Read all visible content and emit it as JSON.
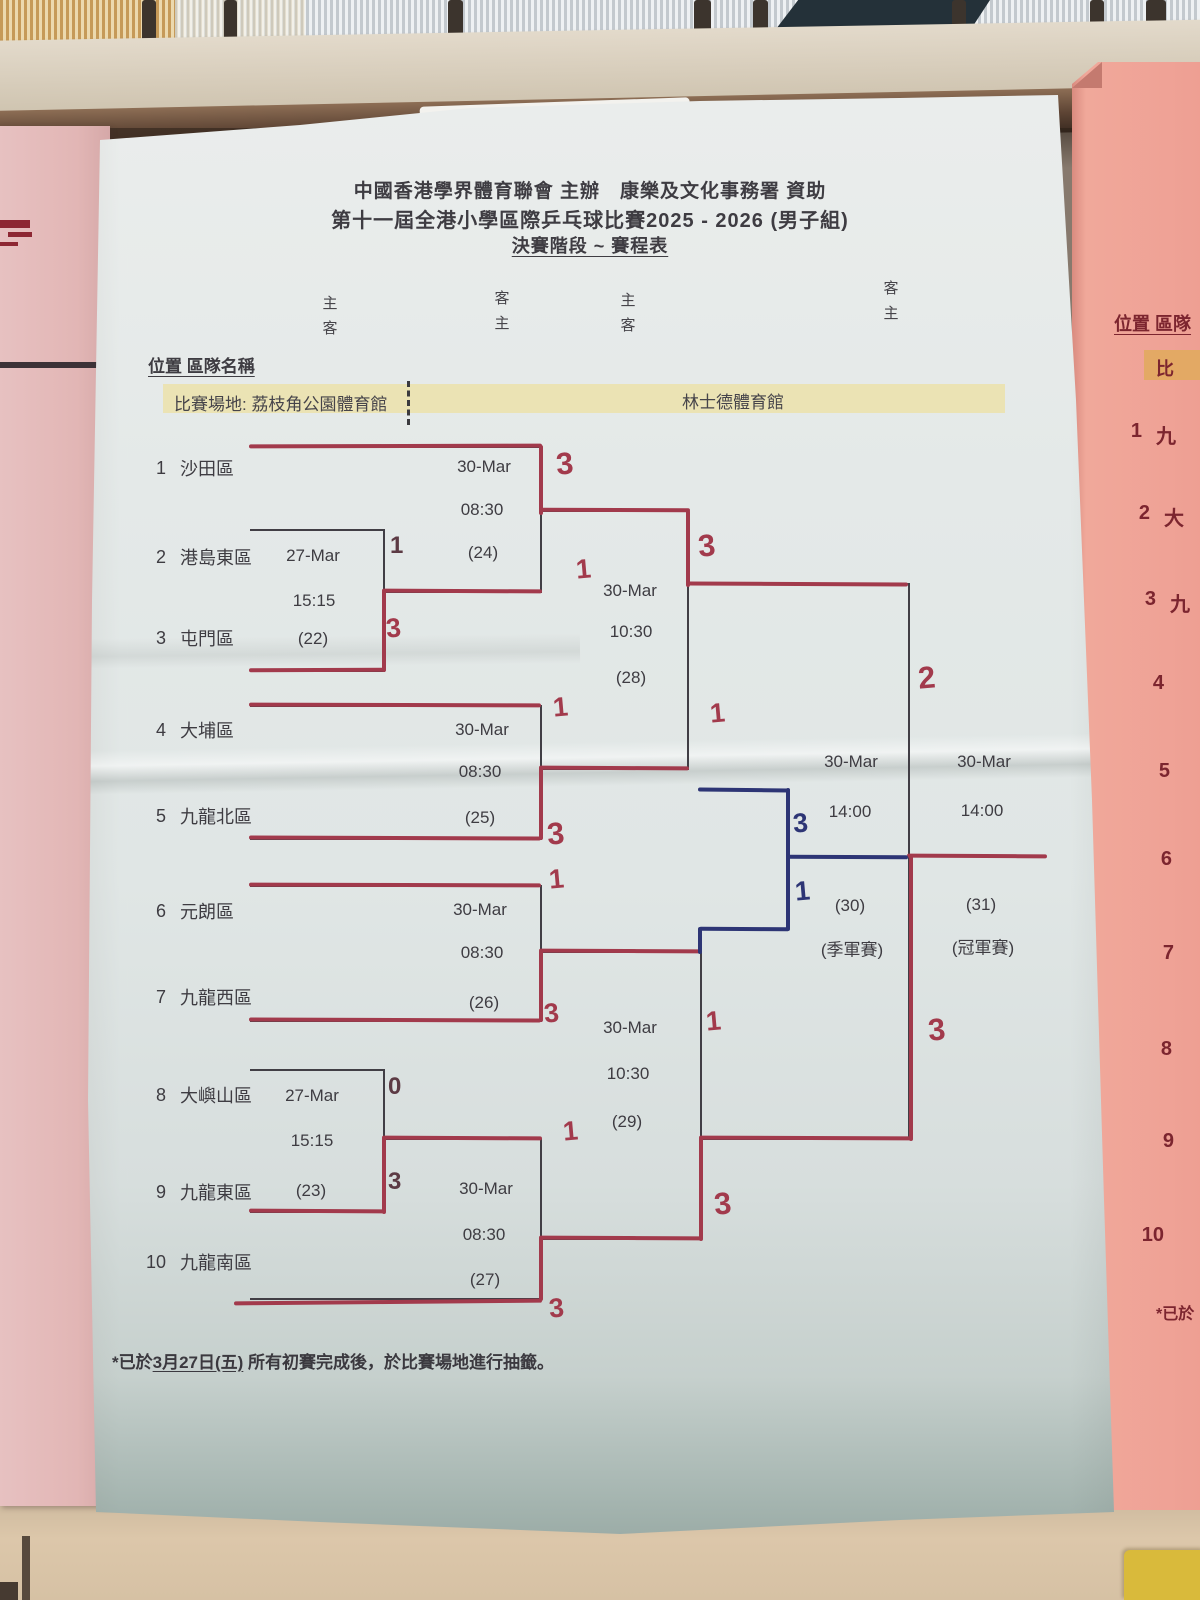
{
  "title": {
    "line1": "中國香港學界體育聯會 主辦　康樂及文化事務署 資助",
    "line2": "第十一屆全港小學區際乒乓球比賽2025 - 2026 (男子組)",
    "line3": "決賽階段 ~ 賽程表"
  },
  "headers": {
    "cols": [
      {
        "top": "主",
        "bottom": "客"
      },
      {
        "top": "客",
        "bottom": "主"
      },
      {
        "top": "主",
        "bottom": "客"
      },
      {
        "top": "客",
        "bottom": "主"
      }
    ],
    "position_label": "位置 區隊名稱"
  },
  "venues": {
    "first": "比賽場地: 荔枝角公園體育館",
    "second": "林士德體育館"
  },
  "teams": [
    {
      "no": "1",
      "name": "沙田區"
    },
    {
      "no": "2",
      "name": "港島東區"
    },
    {
      "no": "3",
      "name": "屯門區"
    },
    {
      "no": "4",
      "name": "大埔區"
    },
    {
      "no": "5",
      "name": "九龍北區"
    },
    {
      "no": "6",
      "name": "元朗區"
    },
    {
      "no": "7",
      "name": "九龍西區"
    },
    {
      "no": "8",
      "name": "大嶼山區"
    },
    {
      "no": "9",
      "name": "九龍東區"
    },
    {
      "no": "10",
      "name": "九龍南區"
    }
  ],
  "matches": {
    "m22": {
      "date": "27-Mar",
      "time": "15:15",
      "code": "(22)",
      "score_top": "1",
      "score_bottom": "3"
    },
    "m23": {
      "date": "27-Mar",
      "time": "15:15",
      "code": "(23)",
      "score_top": "0",
      "score_bottom": "3"
    },
    "m24": {
      "date": "30-Mar",
      "time": "08:30",
      "code": "(24)",
      "score_top": "3",
      "score_bottom": "1"
    },
    "m25": {
      "date": "30-Mar",
      "time": "08:30",
      "code": "(25)",
      "score_top": "1",
      "score_bottom": "3"
    },
    "m26": {
      "date": "30-Mar",
      "time": "08:30",
      "code": "(26)",
      "score_top": "1",
      "score_bottom": "3"
    },
    "m27": {
      "date": "30-Mar",
      "time": "08:30",
      "code": "(27)",
      "score_top": "1",
      "score_bottom": "3"
    },
    "m28": {
      "date": "30-Mar",
      "time": "10:30",
      "code": "(28)",
      "score_top": "3",
      "score_bottom": "1"
    },
    "m29": {
      "date": "30-Mar",
      "time": "10:30",
      "code": "(29)",
      "score_top": "1",
      "score_bottom": "3"
    },
    "m30": {
      "date": "30-Mar",
      "time": "14:00",
      "code": "(30)",
      "label": "(季軍賽)",
      "score_top": "3",
      "score_bottom": "1"
    },
    "m31": {
      "date": "30-Mar",
      "time": "14:00",
      "code": "(31)",
      "label": "(冠軍賽)",
      "score_top": "2",
      "score_bottom": "3"
    }
  },
  "footnote": {
    "pre": "*已於",
    "date": "3月27日(五)",
    "post": " 所有初賽完成後，於比賽場地進行抽籤。"
  },
  "side_sheet": {
    "header": "位置 區隊",
    "venue": "比",
    "rows": [
      {
        "no": "1",
        "name": "九"
      },
      {
        "no": "2",
        "name": "大"
      },
      {
        "no": "3",
        "name": "九"
      },
      {
        "no": "4",
        "name": ""
      },
      {
        "no": "5",
        "name": ""
      },
      {
        "no": "6",
        "name": ""
      },
      {
        "no": "7",
        "name": ""
      },
      {
        "no": "8",
        "name": ""
      },
      {
        "no": "9",
        "name": ""
      },
      {
        "no": "10",
        "name": ""
      }
    ],
    "footnote": "*已於"
  },
  "colors": {
    "red_pen": "#a23a4c",
    "blue_pen": "#2d3575",
    "highlight": "#ebe2ae",
    "ink": "#3e3c42",
    "paper": "#e4e9e8",
    "pink_right": "#efa296",
    "pink_left": "#e2b6b5"
  }
}
